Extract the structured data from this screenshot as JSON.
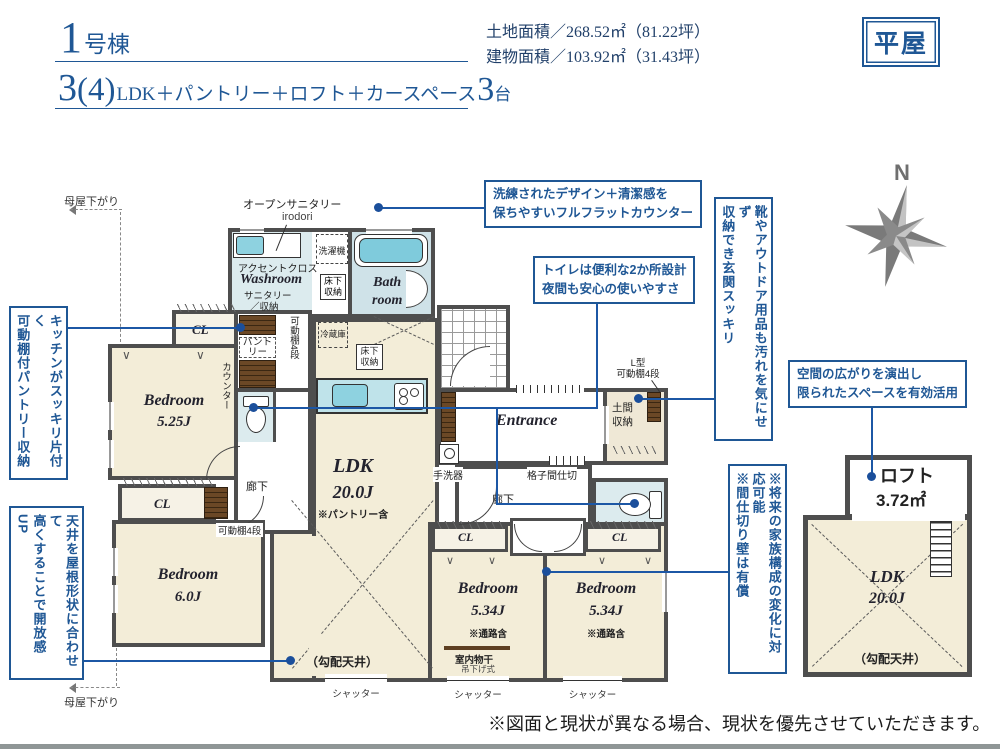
{
  "header": {
    "unit_no": "1",
    "unit_suffix": "号棟",
    "plan_num": "3",
    "plan_paren": "(4)",
    "plan_desc": "LDK＋パントリー＋ロフト＋カースペース",
    "plan_count": "3",
    "plan_unit": "台",
    "land_area": "土地面積／268.52㎡（81.22坪）",
    "building_area": "建物面積／103.92㎡（31.43坪）",
    "badge": "平屋"
  },
  "callouts": {
    "counter_l1": "洗練されたデザイン＋清潔感を",
    "counter_l2": "保ちやすいフルフラットカウンター",
    "toilet_l1": "トイレは便利な2か所設計",
    "toilet_l2": "夜間も安心の使いやすさ",
    "space_l1": "空間の広がりを演出し",
    "space_l2": "限られたスペースを有効活用",
    "entrance_c1": "靴やアウトドア用品も汚れを気にせず",
    "entrance_c2": "収納でき玄関スッキリ",
    "partition_c1": "※将来の家族構成の変化に対応可能",
    "partition_c2": "※間仕切り壁は有償",
    "kitchen_c1": "キッチンがスッキリ片付く",
    "kitchen_c2": "可動棚付パントリー収納",
    "ceiling_c1": "天井を屋根形状に合わせて",
    "ceiling_c2": "高くすることで開放感UP"
  },
  "plan": {
    "open_sanitary": "オープンサニタリー",
    "irodori": "irodori",
    "accent": "アクセントクロス",
    "washroom": "Washroom",
    "sanitary1": "サニタリー",
    "sanitary2": "／収納",
    "washer": "洗濯機",
    "underfloor": "床下収納",
    "bath1": "Bath",
    "bath2": "room",
    "cl": "CL",
    "pantry": "パントリー",
    "shelf4": "可動棚4段",
    "counter_v": "カウンター",
    "fridge": "冷蔵庫",
    "bedroom": "Bedroom",
    "size1": "5.25J",
    "size2": "6.0J",
    "size34": "5.34J",
    "passage": "※通路含",
    "corridor": "廊下",
    "ldk": "LDK",
    "ldk_size": "20.0J",
    "ldk_note": "※パントリー含",
    "entrance": "Entrance",
    "handwash": "手洗器",
    "lattice": "格子間仕切",
    "doma": "土間収納",
    "lshelf1": "L型",
    "monohoshi": "室内物干",
    "monosub": "吊下げ式",
    "shutter": "シャッター",
    "sloped": "（勾配天井）",
    "moya": "母屋下がり"
  },
  "loft": {
    "name": "ロフト",
    "size": "3.72㎡"
  },
  "compass": {
    "label": "N"
  },
  "footer": {
    "disclaimer": "※図面と現状が異なる場合、現状を優先させていただきます。"
  },
  "colors": {
    "navy": "#1f5795",
    "wall": "#4e4e4e",
    "cream": "#f3edd8",
    "aqua": "#dcebee",
    "teal": "#8ed2e0",
    "brown": "#6b4826"
  }
}
